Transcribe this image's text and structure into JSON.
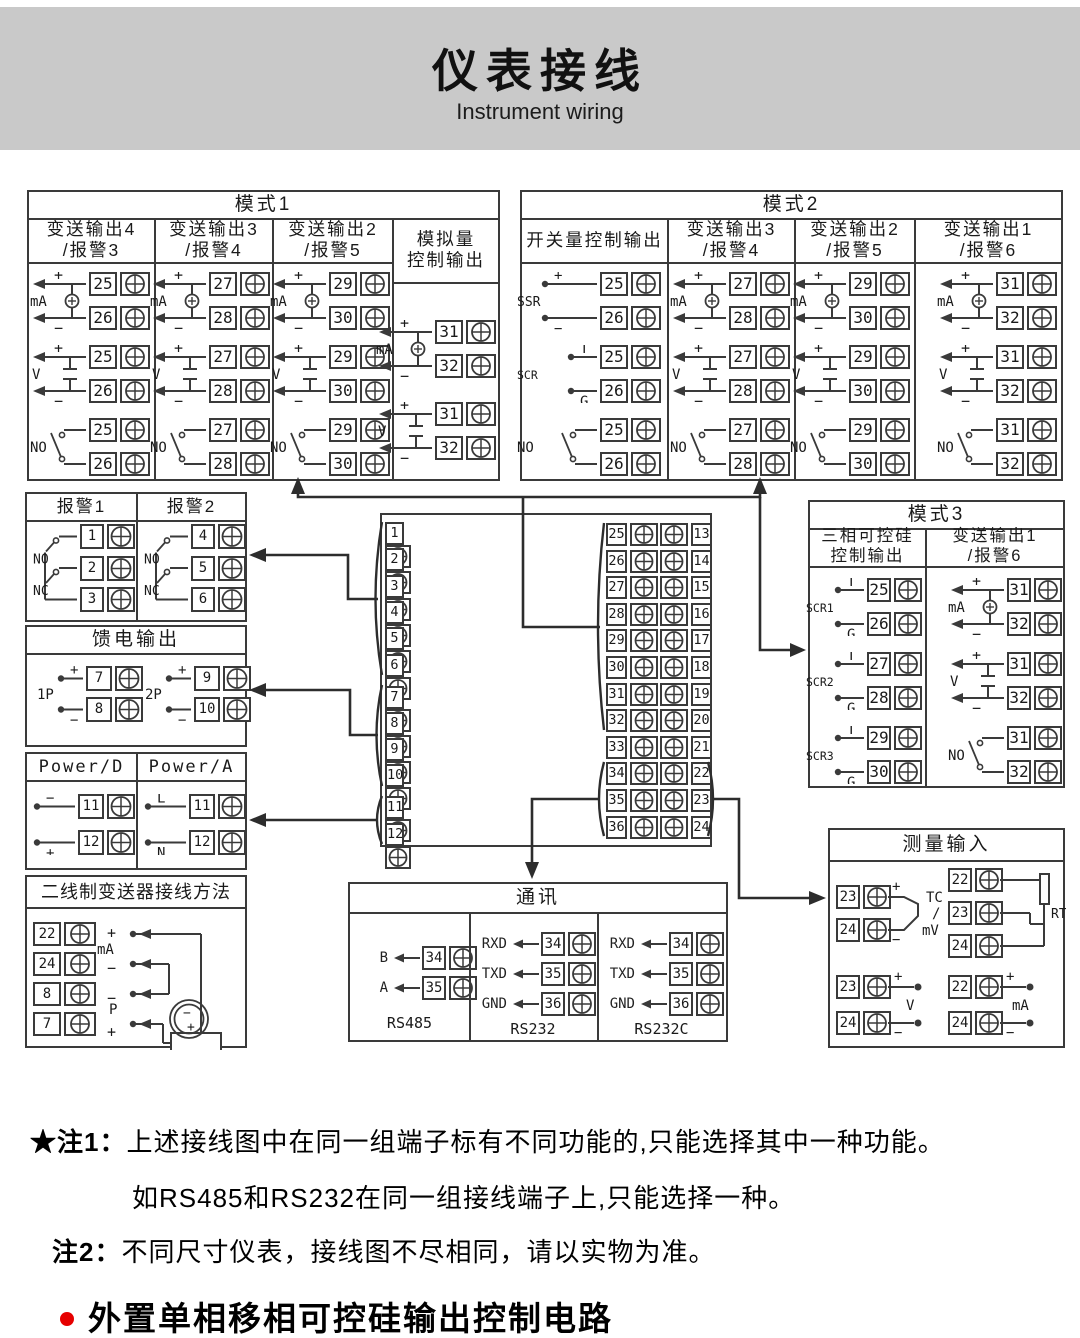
{
  "header": {
    "title": "仪表接线",
    "subtitle": "Instrument wiring"
  },
  "sym": {
    "plus": "+",
    "minus": "−"
  },
  "mode1": {
    "title": "模式1",
    "columns": [
      {
        "header_lines": [
          "变送输出4",
          "/报警3"
        ],
        "groups": [
          {
            "type": "ma",
            "label": "mA",
            "terminals": [
              "25",
              "26"
            ]
          },
          {
            "type": "v",
            "label": "V",
            "terminals": [
              "25",
              "26"
            ]
          },
          {
            "type": "no",
            "label": "NO",
            "terminals": [
              "25",
              "26"
            ]
          }
        ]
      },
      {
        "header_lines": [
          "变送输出3",
          "/报警4"
        ],
        "groups": [
          {
            "type": "ma",
            "label": "mA",
            "terminals": [
              "27",
              "28"
            ]
          },
          {
            "type": "v",
            "label": "V",
            "terminals": [
              "27",
              "28"
            ]
          },
          {
            "type": "no",
            "label": "NO",
            "terminals": [
              "27",
              "28"
            ]
          }
        ]
      },
      {
        "header_lines": [
          "变送输出2",
          "/报警5"
        ],
        "groups": [
          {
            "type": "ma",
            "label": "mA",
            "terminals": [
              "29",
              "30"
            ]
          },
          {
            "type": "v",
            "label": "V",
            "terminals": [
              "29",
              "30"
            ]
          },
          {
            "type": "no",
            "label": "NO",
            "terminals": [
              "29",
              "30"
            ]
          }
        ]
      },
      {
        "header_lines": [
          "模拟量",
          "控制输出"
        ],
        "groups": [
          {
            "type": "ma",
            "label": "mA",
            "terminals": [
              "31",
              "32"
            ]
          },
          {
            "type": "v",
            "label": "V",
            "terminals": [
              "31",
              "32"
            ]
          }
        ]
      }
    ]
  },
  "mode2": {
    "title": "模式2",
    "columns": [
      {
        "header_lines": [
          "开关量控制输出"
        ],
        "groups": [
          {
            "type": "ssr",
            "label": "SSR",
            "top": "+",
            "bottom": "−",
            "terminals": [
              "25",
              "26"
            ]
          },
          {
            "type": "scr",
            "label": "SCR",
            "top": "T",
            "bottom": "G",
            "terminals": [
              "25",
              "26"
            ]
          },
          {
            "type": "no",
            "label": "NO",
            "terminals": [
              "25",
              "26"
            ]
          }
        ]
      },
      {
        "header_lines": [
          "变送输出3",
          "/报警4"
        ],
        "groups": [
          {
            "type": "ma",
            "label": "mA",
            "terminals": [
              "27",
              "28"
            ]
          },
          {
            "type": "v",
            "label": "V",
            "terminals": [
              "27",
              "28"
            ]
          },
          {
            "type": "no",
            "label": "NO",
            "terminals": [
              "27",
              "28"
            ]
          }
        ]
      },
      {
        "header_lines": [
          "变送输出2",
          "/报警5"
        ],
        "groups": [
          {
            "type": "ma",
            "label": "mA",
            "terminals": [
              "29",
              "30"
            ]
          },
          {
            "type": "v",
            "label": "V",
            "terminals": [
              "29",
              "30"
            ]
          },
          {
            "type": "no",
            "label": "NO",
            "terminals": [
              "29",
              "30"
            ]
          }
        ]
      },
      {
        "header_lines": [
          "变送输出1",
          "/报警6"
        ],
        "groups": [
          {
            "type": "ma",
            "label": "mA",
            "terminals": [
              "31",
              "32"
            ]
          },
          {
            "type": "v",
            "label": "V",
            "terminals": [
              "31",
              "32"
            ]
          },
          {
            "type": "no",
            "label": "NO",
            "terminals": [
              "31",
              "32"
            ]
          }
        ]
      }
    ]
  },
  "mode3": {
    "title": "模式3",
    "columns": [
      {
        "header_lines": [
          "三相可控硅",
          "控制输出"
        ],
        "groups": [
          {
            "type": "scr",
            "label": "SCR1",
            "top": "T",
            "bottom": "G",
            "terminals": [
              "25",
              "26"
            ]
          },
          {
            "type": "scr",
            "label": "SCR2",
            "top": "T",
            "bottom": "G",
            "terminals": [
              "27",
              "28"
            ]
          },
          {
            "type": "scr",
            "label": "SCR3",
            "top": "T",
            "bottom": "G",
            "terminals": [
              "29",
              "30"
            ]
          }
        ]
      },
      {
        "header_lines": [
          "变送输出1",
          "/报警6"
        ],
        "groups": [
          {
            "type": "ma",
            "label": "mA",
            "terminals": [
              "31",
              "32"
            ]
          },
          {
            "type": "v",
            "label": "V",
            "terminals": [
              "31",
              "32"
            ]
          },
          {
            "type": "no",
            "label": "NO",
            "terminals": [
              "31",
              "32"
            ]
          }
        ]
      }
    ]
  },
  "alarm": {
    "columns": [
      {
        "header": "报警1",
        "no_label": "NO",
        "nc_label": "NC",
        "terminals": [
          "1",
          "2",
          "3"
        ]
      },
      {
        "header": "报警2",
        "no_label": "NO",
        "nc_label": "NC",
        "terminals": [
          "4",
          "5",
          "6"
        ]
      }
    ]
  },
  "feed": {
    "title": "馈电输出",
    "groups": [
      {
        "label": "1P",
        "top": "+",
        "bottom": "−",
        "terminals": [
          "7",
          "8"
        ]
      },
      {
        "label": "2P",
        "top": "+",
        "bottom": "−",
        "terminals": [
          "9",
          "10"
        ]
      }
    ]
  },
  "power": {
    "columns": [
      {
        "header": "Power/D",
        "top": "−",
        "bottom": "+",
        "terminals": [
          "11",
          "12"
        ]
      },
      {
        "header": "Power/A",
        "top": "L",
        "bottom": "N",
        "terminals": [
          "11",
          "12"
        ]
      }
    ]
  },
  "twowire": {
    "title": "二线制变送器接线方法",
    "rows": [
      {
        "num": "22",
        "label": "+"
      },
      {
        "num": "24",
        "label": "−"
      },
      {
        "num": "8",
        "label": "−"
      },
      {
        "num": "7",
        "label": "+"
      }
    ],
    "ma_label": "mA",
    "p_label": "P",
    "tx_minus": "−",
    "tx_plus": "+"
  },
  "block": {
    "left": [
      "1",
      "2",
      "3",
      "4",
      "5",
      "6",
      "7",
      "8",
      "9",
      "10",
      "11",
      "12"
    ],
    "mid": [
      "25",
      "26",
      "27",
      "28",
      "29",
      "30",
      "31",
      "32",
      "33",
      "34",
      "35",
      "36"
    ],
    "right": [
      "13",
      "14",
      "15",
      "16",
      "17",
      "18",
      "19",
      "20",
      "21",
      "22",
      "23",
      "24"
    ]
  },
  "measure": {
    "title": "测量输入",
    "tc": {
      "terminals": [
        "23",
        "24"
      ],
      "plus": "+",
      "minus": "−",
      "lines": [
        "TC",
        "/",
        "mV"
      ]
    },
    "rtd": {
      "terminals": [
        "22",
        "23",
        "24"
      ],
      "label": "RTD"
    },
    "v": {
      "terminals": [
        "23",
        "24"
      ],
      "plus": "+",
      "minus": "−",
      "label": "V"
    },
    "ma": {
      "terminals": [
        "22",
        "24"
      ],
      "plus": "+",
      "minus": "−",
      "label": "mA"
    }
  },
  "comm": {
    "title": "通讯",
    "sections": [
      {
        "caption": "RS485",
        "rows": [
          {
            "label": "B",
            "num": "34"
          },
          {
            "label": "A",
            "num": "35"
          }
        ]
      },
      {
        "caption": "RS232",
        "rows": [
          {
            "label": "RXD",
            "num": "34"
          },
          {
            "label": "TXD",
            "num": "35"
          },
          {
            "label": "GND",
            "num": "36"
          }
        ]
      },
      {
        "caption": "RS232C",
        "rows": [
          {
            "label": "RXD",
            "num": "34"
          },
          {
            "label": "TXD",
            "num": "35"
          },
          {
            "label": "GND",
            "num": "36"
          }
        ]
      }
    ]
  },
  "notes": {
    "note1_tag": "★注1：",
    "note1_text": "上述接线图中在同一组端子标有不同功能的,只能选择其中一种功能。",
    "note1_line2": "如RS485和RS232在同一组接线端子上,只能选择一种。",
    "note2_tag": "注2：",
    "note2_text": "不同尺寸仪表，接线图不尽相同，请以实物为准。",
    "bullet_text": "外置单相移相可控硅输出控制电路"
  },
  "colors": {
    "line": "#3a3a3a",
    "header_bg": "#c9c9c9",
    "accent_red": "#e60000"
  }
}
